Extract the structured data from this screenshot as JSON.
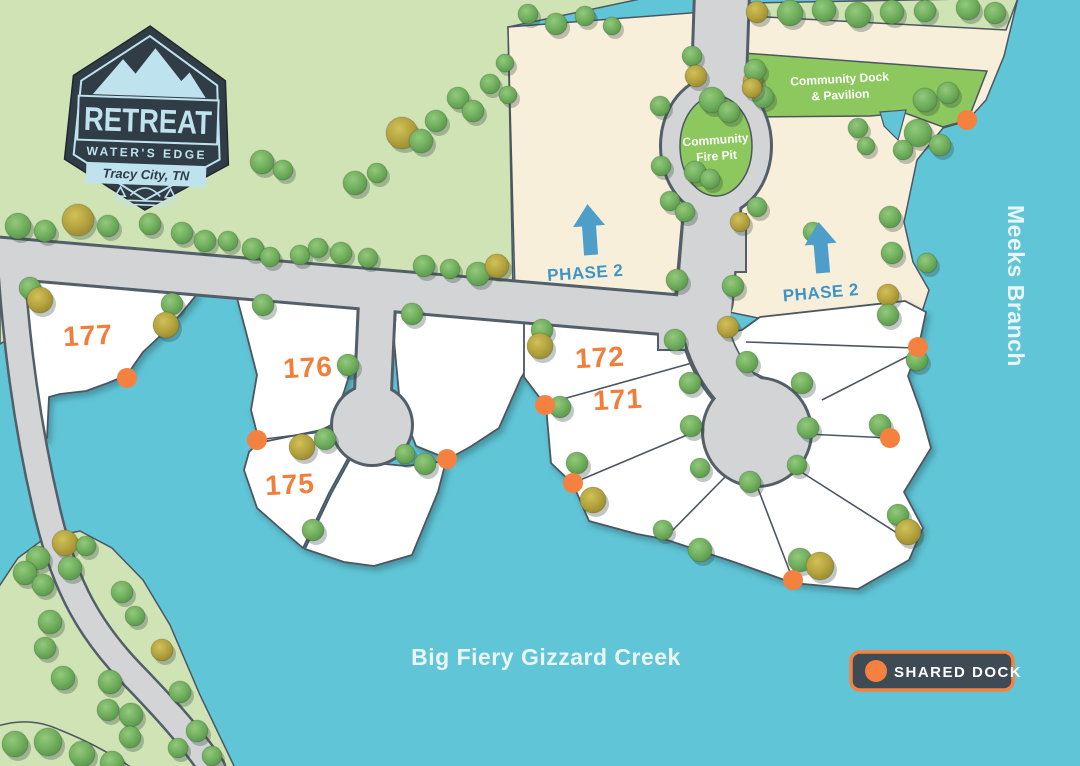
{
  "title": "Retreat Water's Edge Site Plan",
  "logo": {
    "title": "RETREAT",
    "subtitle": "WATER'S EDGE",
    "location": "Tracy City, TN"
  },
  "lots": {
    "labels": [
      "177",
      "176",
      "175",
      "172",
      "171"
    ]
  },
  "phase2": {
    "label": "PHASE 2"
  },
  "amenities": {
    "fire_pit_line1": "Community",
    "fire_pit_line2": "Fire Pit",
    "dock_line1": "Community Dock",
    "dock_line2": "& Pavilion"
  },
  "water": {
    "creek": "Big Fiery Gizzard Creek",
    "branch": "Meeks Branch"
  },
  "legend": {
    "label": "SHARED DOCK"
  },
  "colors": {
    "water": "#60c5d6",
    "grass": "#cfe3b5",
    "cream": "#f8efda",
    "road_fill": "#d3d4d6",
    "road_casing": "#535f68",
    "lot_fill": "#ffffff",
    "lot_stroke": "#4b5661",
    "community_green": "#8cc85e",
    "dock_orange": "#f58140",
    "phase_blue": "#4d9fc9",
    "phase_text": "#3e95c5",
    "lot_number": "#f07f3c",
    "label_white": "#e9f6f8",
    "legend_bg": "#3f4b54",
    "logo_dark": "#313d46",
    "logo_light": "#bfe2ef"
  }
}
